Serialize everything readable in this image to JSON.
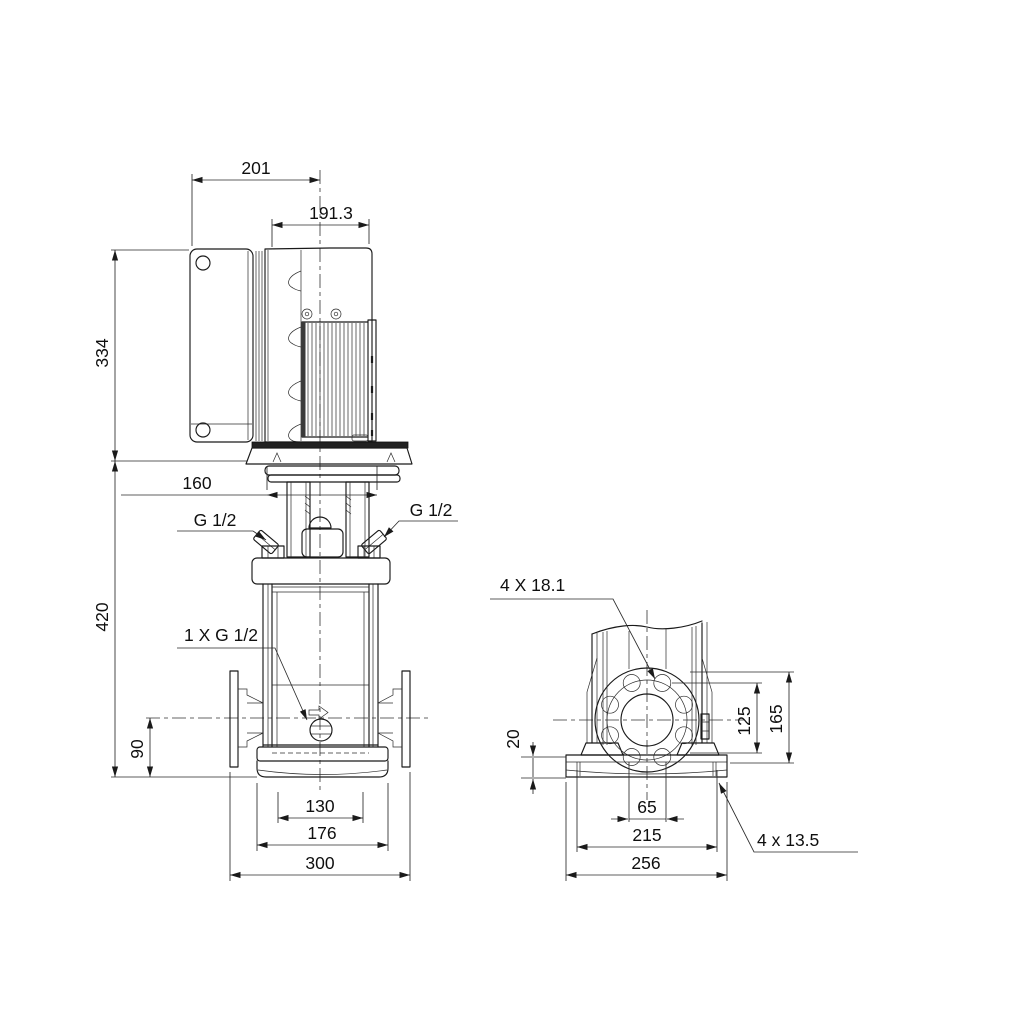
{
  "title": "Pump dimensional drawing",
  "colors": {
    "background": "#ffffff",
    "line": "#1a1a1a",
    "text": "#0f0f0f"
  },
  "front_view": {
    "dimensions": {
      "control_box_width": "201",
      "motor_width": "191.3",
      "motor_height": "334",
      "fan_cover_diameter": "160",
      "pump_height": "420",
      "port_center_height": "90",
      "foot_width": "130",
      "base_width": "176",
      "flange_to_flange": "300"
    },
    "labels": {
      "gauge_port_left": "G 1/2",
      "gauge_port_right": "G 1/2",
      "drain_port": "1 X G 1/2"
    }
  },
  "side_view": {
    "dimensions": {
      "flange_bolt_holes": "4 X 18.1",
      "flange_hole_spacing": "125",
      "flange_height": "165",
      "base_plate_thickness": "20",
      "chamber_width": "65",
      "base_hole_spacing": "215",
      "base_plate_width": "256",
      "base_bolt_holes": "4 x 13.5"
    }
  }
}
